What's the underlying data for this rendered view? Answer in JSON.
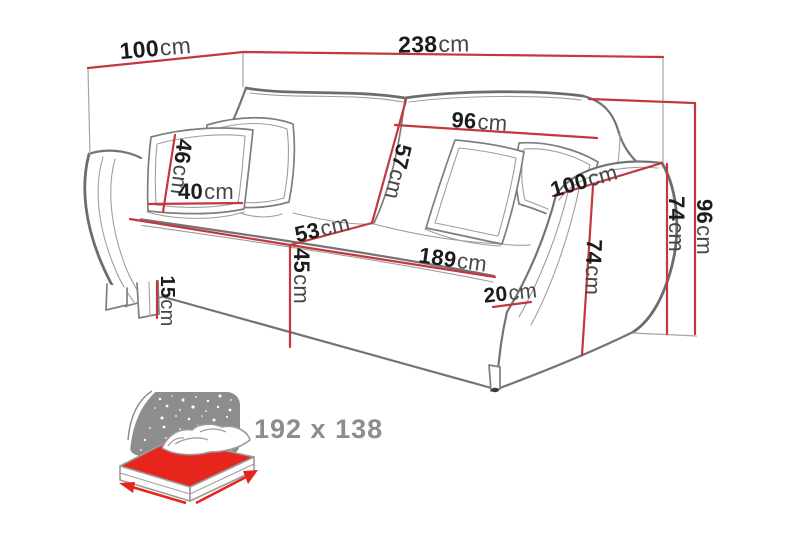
{
  "figure": {
    "type": "sofa-bed-dimension-diagram",
    "unit": "cm",
    "colors": {
      "background": "#ffffff",
      "dimension_line": "#c2383c",
      "sketch_line": "#7e7e7e",
      "number_text": "#1c1c1c",
      "unit_text": "#474747",
      "icon_gray": "#8d8d8d",
      "icon_red": "#e8251d"
    }
  },
  "dimensions": {
    "depth_top": {
      "value": "100",
      "unit": "cm"
    },
    "width_total": {
      "value": "238",
      "unit": "cm"
    },
    "backrest_cushion_width": {
      "value": "96",
      "unit": "cm"
    },
    "backrest_height": {
      "value": "57",
      "unit": "cm"
    },
    "pillow_height": {
      "value": "46",
      "unit": "cm"
    },
    "pillow_width": {
      "value": "40",
      "unit": "cm"
    },
    "seat_depth": {
      "value": "53",
      "unit": "cm"
    },
    "seat_height": {
      "value": "45",
      "unit": "cm"
    },
    "leg_height": {
      "value": "15",
      "unit": "cm"
    },
    "seat_width": {
      "value": "189",
      "unit": "cm"
    },
    "armrest_width": {
      "value": "20",
      "unit": "cm"
    },
    "armrest_depth": {
      "value": "100",
      "unit": "cm"
    },
    "armrest_height_front": {
      "value": "74",
      "unit": "cm"
    },
    "armrest_height_outer": {
      "value": "74",
      "unit": "cm"
    },
    "total_height": {
      "value": "96",
      "unit": "cm"
    }
  },
  "sleeping_area": {
    "size": "192 x 138"
  }
}
